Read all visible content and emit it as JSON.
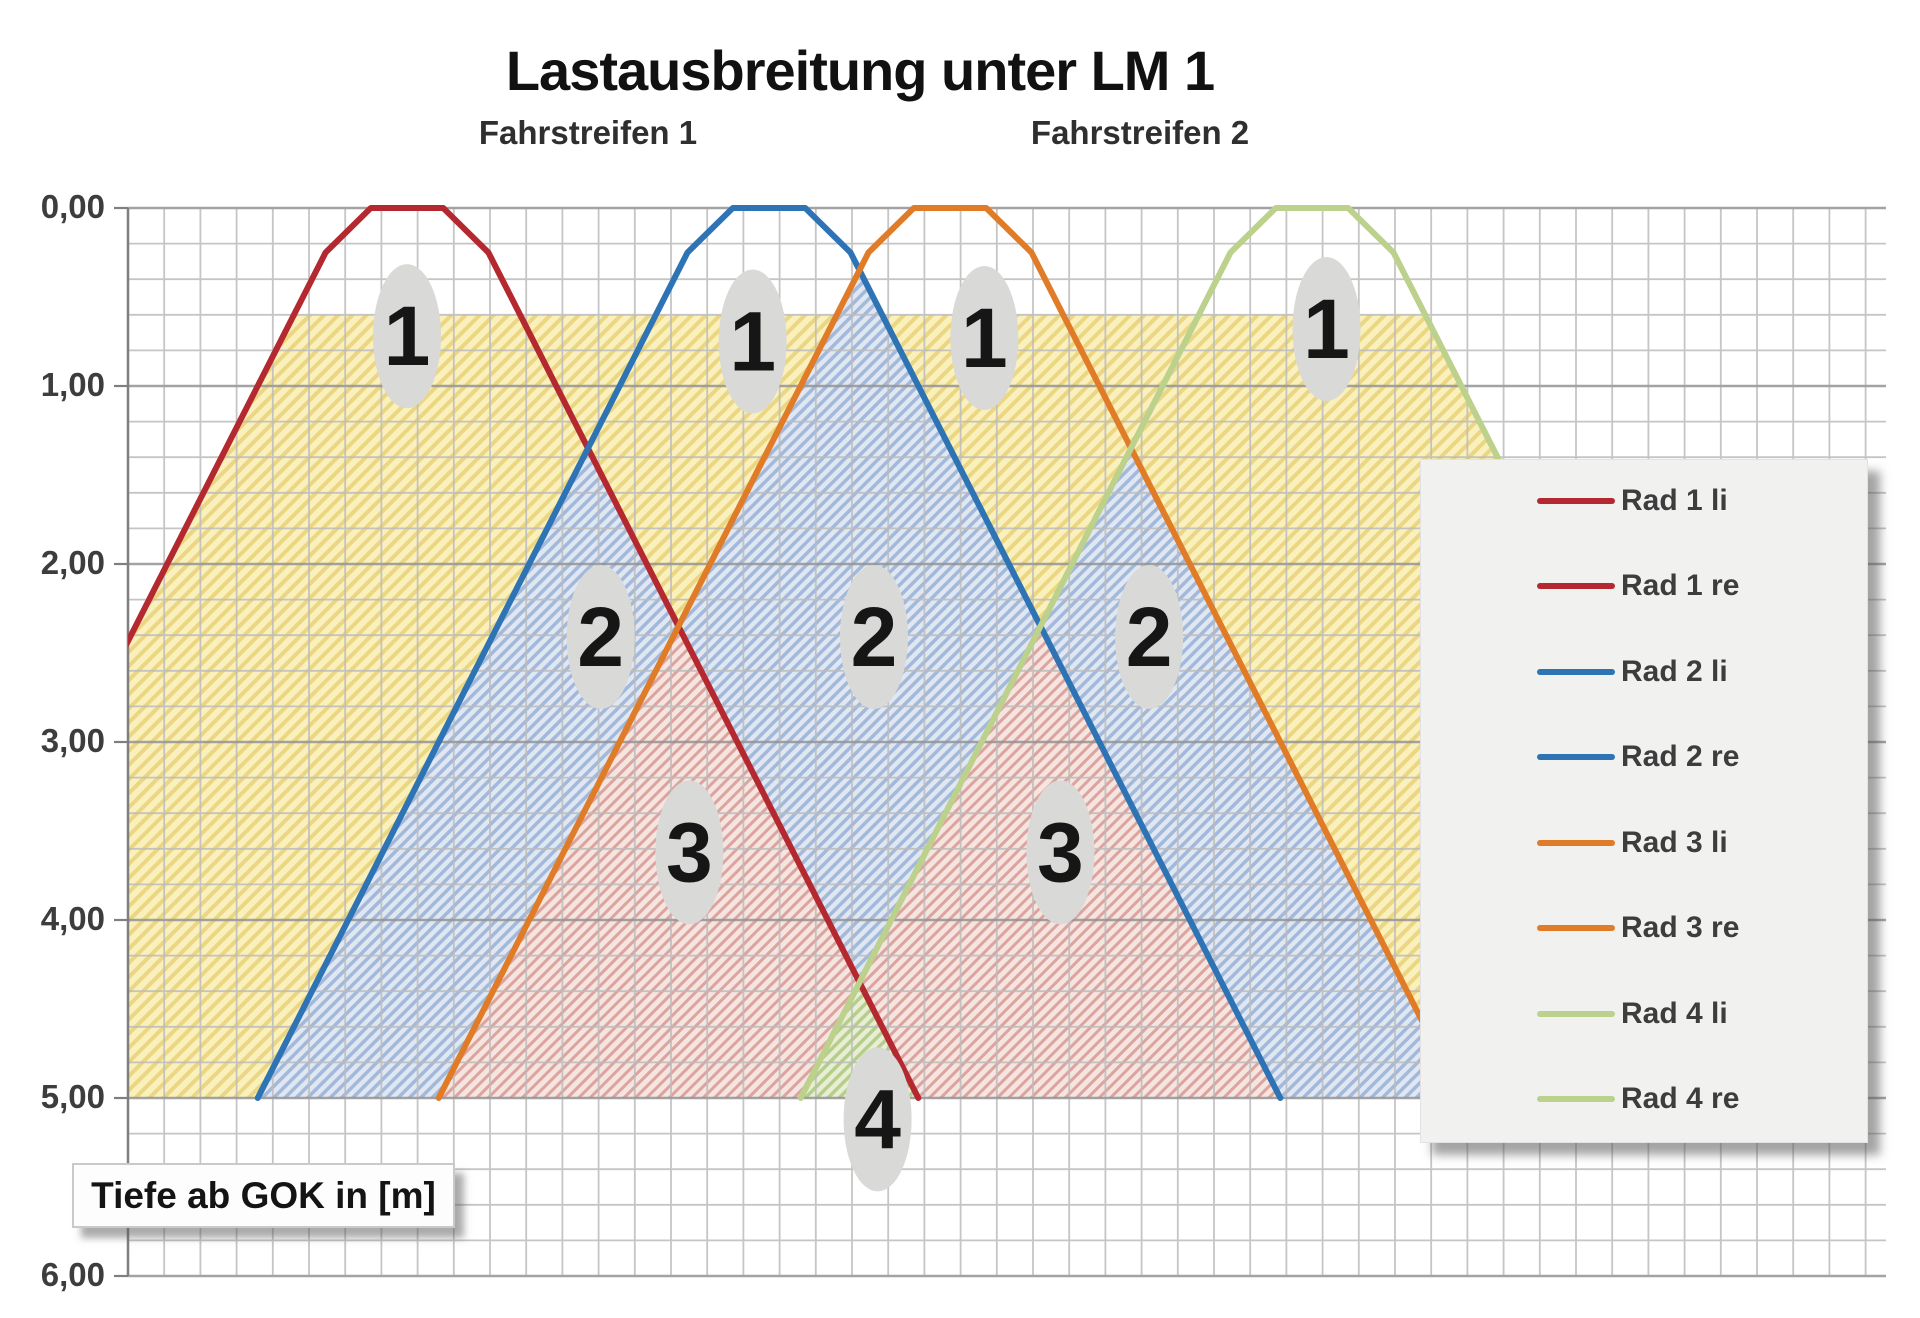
{
  "title": "Lastausbreitung unter LM 1",
  "lanes": [
    {
      "label": "Fahrstreifen 1",
      "x_m": 1.0
    },
    {
      "label": "Fahrstreifen 2",
      "x_m": 4.05
    }
  ],
  "axis": {
    "title": "Tiefe ab GOK in [m]",
    "tick_labels": [
      "0,00",
      "1,00",
      "2,00",
      "3,00",
      "4,00",
      "5,00",
      "6,00"
    ]
  },
  "legend": {
    "entries": [
      {
        "label": "Rad 1 li",
        "color": "#B4292F"
      },
      {
        "label": "Rad 1 re",
        "color": "#B4292F"
      },
      {
        "label": "Rad 2 li",
        "color": "#2E74B5"
      },
      {
        "label": "Rad 2 re",
        "color": "#2E74B5"
      },
      {
        "label": "Rad 3 li",
        "color": "#E07C28"
      },
      {
        "label": "Rad 3 re",
        "color": "#E07C28"
      },
      {
        "label": "Rad 4 li",
        "color": "#BCD18B"
      },
      {
        "label": "Rad 4 re",
        "color": "#BCD18B"
      }
    ]
  },
  "chart_data": {
    "type": "line",
    "title": "Lastausbreitung unter LM 1",
    "ylabel": "Tiefe ab GOK in [m]",
    "y_axis": {
      "min": 0,
      "max": 6,
      "major_unit": 1.0,
      "minor_unit": 0.2,
      "format": "comma-decimal",
      "direction": "down"
    },
    "x_axis": {
      "min_m": -1.541,
      "max_m": 8.17,
      "minor_unit": 0.2,
      "labels_visible": false
    },
    "grid": true,
    "legend_position": "right-overlay",
    "geometry": {
      "wheel_half_width_m": 0.2,
      "kink_depth_m": 0.25,
      "spread_dx_per_dz_below_kink": 0.5,
      "spread_bottom_m": 5.0,
      "shading_top_m": 0.6,
      "wheel_centers_m": {
        "Rad 1": 0.0,
        "Rad 2": 2.0,
        "Rad 3": 3.0,
        "Rad 4": 5.0
      }
    },
    "series": [
      {
        "name": "Rad 1 li",
        "color": "#B4292F",
        "points_m_depth": [
          [
            0.2,
            0
          ],
          [
            -0.2,
            0
          ],
          [
            -0.45,
            0.25
          ],
          [
            -2.825,
            5
          ]
        ]
      },
      {
        "name": "Rad 1 re",
        "color": "#B4292F",
        "points_m_depth": [
          [
            0.2,
            0
          ],
          [
            0.45,
            0.25
          ],
          [
            2.825,
            5
          ]
        ]
      },
      {
        "name": "Rad 2 li",
        "color": "#2E74B5",
        "points_m_depth": [
          [
            2.2,
            0
          ],
          [
            1.8,
            0
          ],
          [
            1.55,
            0.25
          ],
          [
            -0.825,
            5
          ]
        ]
      },
      {
        "name": "Rad 2 re",
        "color": "#2E74B5",
        "points_m_depth": [
          [
            2.2,
            0
          ],
          [
            2.45,
            0.25
          ],
          [
            4.825,
            5
          ]
        ]
      },
      {
        "name": "Rad 3 li",
        "color": "#E07C28",
        "points_m_depth": [
          [
            3.2,
            0
          ],
          [
            2.8,
            0
          ],
          [
            2.55,
            0.25
          ],
          [
            0.175,
            5
          ]
        ]
      },
      {
        "name": "Rad 3 re",
        "color": "#E07C28",
        "points_m_depth": [
          [
            3.2,
            0
          ],
          [
            3.45,
            0.25
          ],
          [
            5.825,
            5
          ]
        ]
      },
      {
        "name": "Rad 4 li",
        "color": "#BCD18B",
        "points_m_depth": [
          [
            5.2,
            0
          ],
          [
            4.8,
            0
          ],
          [
            4.55,
            0.25
          ],
          [
            2.175,
            5
          ]
        ]
      },
      {
        "name": "Rad 4 re",
        "color": "#BCD18B",
        "points_m_depth": [
          [
            5.2,
            0
          ],
          [
            5.45,
            0.25
          ],
          [
            7.825,
            5
          ]
        ]
      }
    ],
    "overlap_regions": [
      {
        "overlap_count": 1,
        "pattern": "yellow",
        "points_m_depth": [
          [
            -0.625,
            0.6
          ],
          [
            5.625,
            0.6
          ],
          [
            7.825,
            5
          ],
          [
            -1.541,
            5
          ],
          [
            -1.541,
            2.432
          ]
        ]
      },
      {
        "overlap_count": 2,
        "pattern": "blue",
        "points_m_depth": [
          [
            1.0,
            1.35
          ],
          [
            2.825,
            5
          ],
          [
            -0.825,
            5
          ]
        ]
      },
      {
        "overlap_count": 2,
        "pattern": "blue",
        "points_m_depth": [
          [
            2.5,
            0.35
          ],
          [
            4.825,
            5
          ],
          [
            0.175,
            5
          ]
        ]
      },
      {
        "overlap_count": 2,
        "pattern": "blue",
        "points_m_depth": [
          [
            4.0,
            1.35
          ],
          [
            5.825,
            5
          ],
          [
            2.175,
            5
          ]
        ]
      },
      {
        "overlap_count": 3,
        "pattern": "pink",
        "points_m_depth": [
          [
            1.5,
            2.35
          ],
          [
            2.825,
            5
          ],
          [
            0.175,
            5
          ]
        ]
      },
      {
        "overlap_count": 3,
        "pattern": "pink",
        "points_m_depth": [
          [
            3.5,
            2.35
          ],
          [
            4.825,
            5
          ],
          [
            2.175,
            5
          ]
        ]
      },
      {
        "overlap_count": 4,
        "pattern": "green",
        "points_m_depth": [
          [
            2.5,
            4.35
          ],
          [
            2.825,
            5
          ],
          [
            2.175,
            5
          ]
        ]
      }
    ],
    "zone_badges": [
      {
        "text": "1",
        "x_m": 0.0,
        "depth_m": 0.72
      },
      {
        "text": "1",
        "x_m": 1.91,
        "depth_m": 0.75
      },
      {
        "text": "1",
        "x_m": 3.19,
        "depth_m": 0.73
      },
      {
        "text": "1",
        "x_m": 5.08,
        "depth_m": 0.68
      },
      {
        "text": "2",
        "x_m": 1.07,
        "depth_m": 2.41
      },
      {
        "text": "2",
        "x_m": 2.58,
        "depth_m": 2.41
      },
      {
        "text": "2",
        "x_m": 4.1,
        "depth_m": 2.41
      },
      {
        "text": "3",
        "x_m": 1.56,
        "depth_m": 3.62
      },
      {
        "text": "3",
        "x_m": 3.61,
        "depth_m": 3.62
      },
      {
        "text": "4",
        "x_m": 2.6,
        "depth_m": 5.12
      }
    ],
    "patterns": {
      "yellow": {
        "bg": "#FAF0BC",
        "stripe": "#EBD684",
        "tile": 10,
        "stripe_w": 4
      },
      "blue": {
        "bg": "#E0E7F2",
        "stripe": "#A2B9DA",
        "tile": 8,
        "stripe_w": 3.5
      },
      "pink": {
        "bg": "#F5E4E0",
        "stripe": "#DCA49E",
        "tile": 8,
        "stripe_w": 3
      },
      "green": {
        "bg": "#E7EED3",
        "stripe": "#B5CE8C",
        "tile": 8,
        "stripe_w": 3.5
      }
    },
    "badge_style": {
      "fill": "#D9D9D7",
      "text_color": "#161616",
      "rx": 34,
      "ry": 72,
      "font_px": 84
    },
    "grid_colors": {
      "minor": "#BCBCBC",
      "major": "#949494",
      "axis": "#7F7F7F"
    }
  },
  "layout": {
    "width": 1920,
    "height": 1318,
    "plot": {
      "left": 128,
      "right": 1886,
      "top": 208,
      "bottom": 1276
    },
    "x0_px": 407,
    "px_per_m_x": 181,
    "y0_px": 208,
    "px_per_m_y": 178,
    "curve_stroke_px": 6,
    "legend_row_centers_px": [
      500,
      585,
      671,
      756,
      842,
      927,
      1013,
      1098
    ],
    "legend_box": {
      "left": 1420,
      "top": 459,
      "width": 446,
      "height": 682
    },
    "y_label_right_px": 105
  }
}
